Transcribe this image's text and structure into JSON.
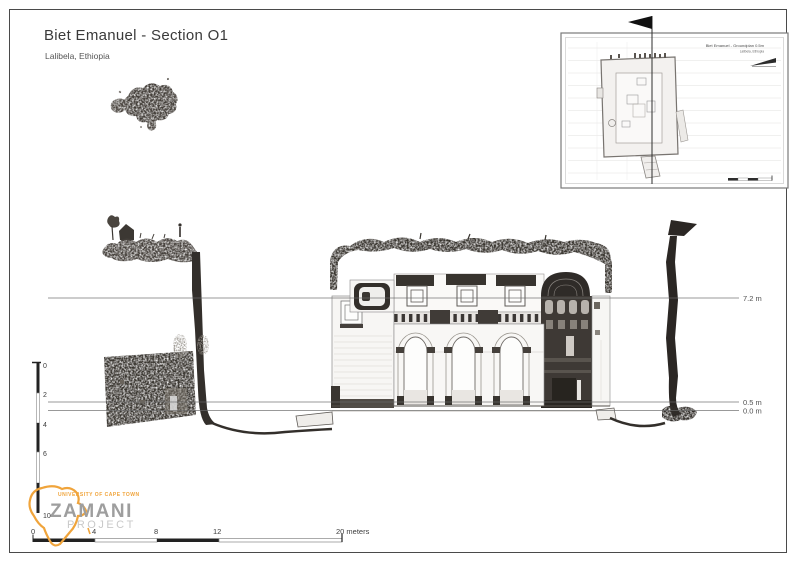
{
  "header": {
    "title": "Biet Emanuel - Section O1",
    "subtitle": "Lalibela, Ethiopia"
  },
  "inset_map": {
    "title": "Biet Emanuel - Groundplan 0.5m",
    "subtitle": "Lalibela, Ethiopia"
  },
  "section_view": {
    "elevation_labels": [
      {
        "label": "7.2 m"
      },
      {
        "label": "0.5 m"
      },
      {
        "label": "0.0 m"
      }
    ]
  },
  "vertical_scale_labels": [
    "0",
    "2",
    "4",
    "6",
    "10"
  ],
  "horizontal_scale_labels": [
    "0",
    "4",
    "8",
    "12"
  ],
  "horizontal_scale_end": "20 meters",
  "logo": {
    "institution": "UNIVERSITY OF CAPE TOWN",
    "name": "ZAMANI",
    "word2": "PROJECT"
  },
  "colors": {
    "accent_orange": "#F0A43B",
    "drawing_ink": "#38342F",
    "line_gray": "#6A6A6A"
  }
}
